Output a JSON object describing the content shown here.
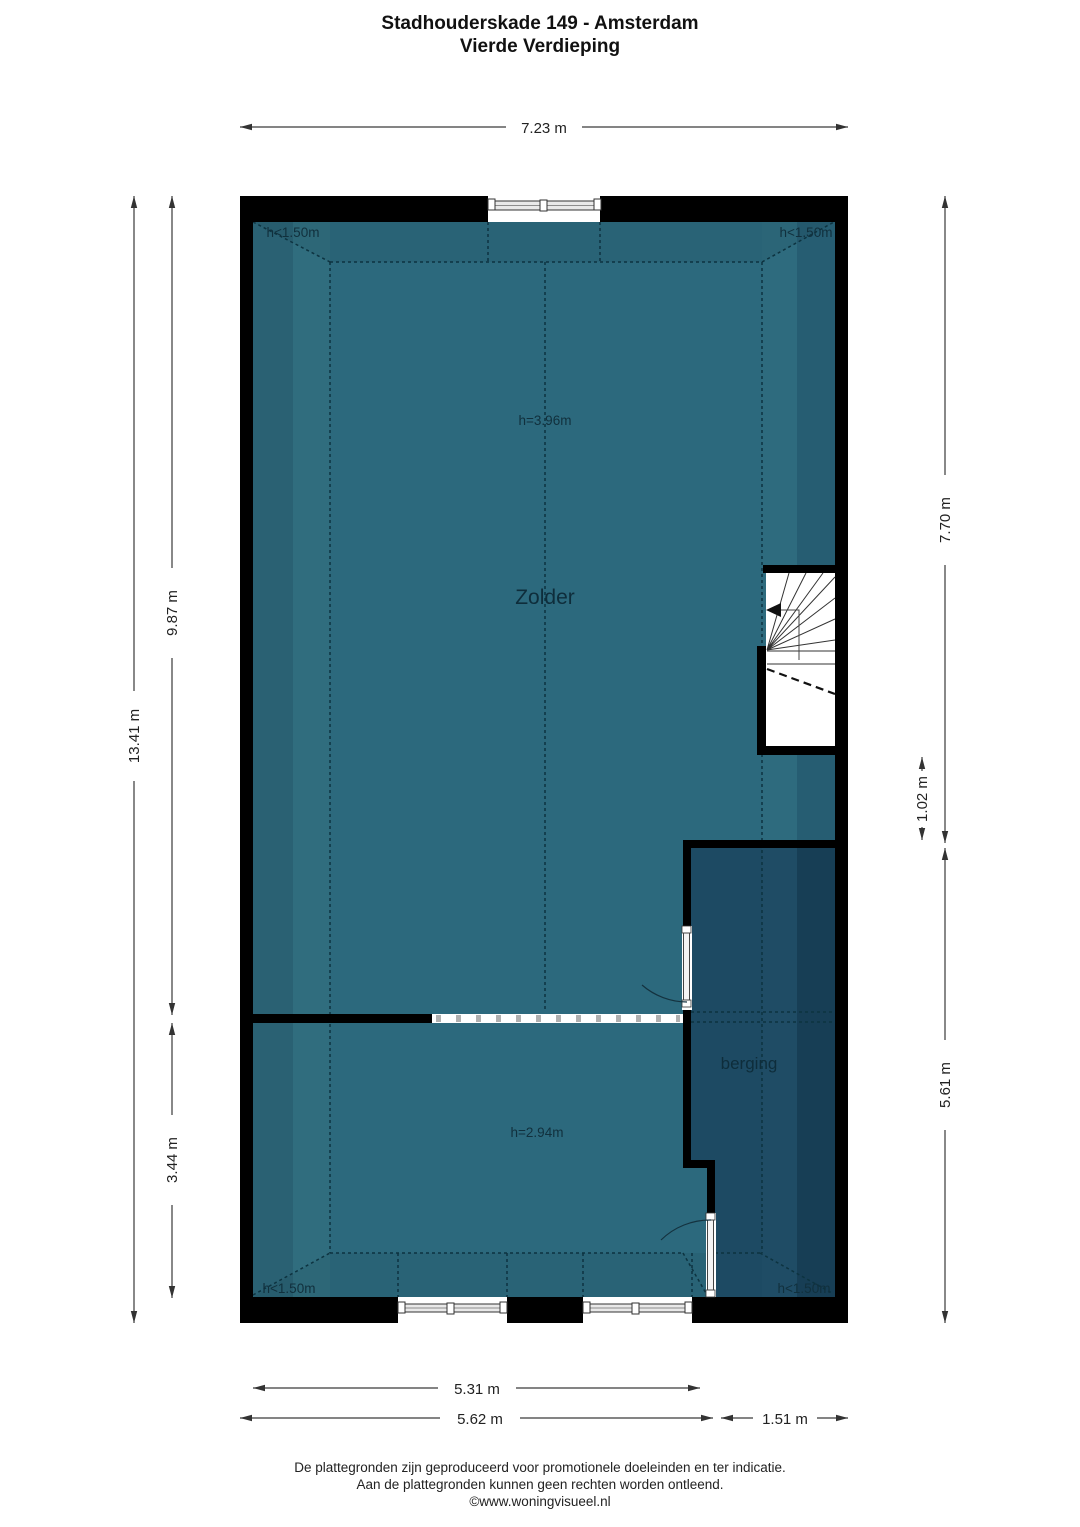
{
  "title": {
    "line1": "Stadhouderskade 149 - Amsterdam",
    "line2": "Vierde Verdieping"
  },
  "plan": {
    "rooms": [
      {
        "name": "zolder",
        "label": "Zolder"
      },
      {
        "name": "berging",
        "label": "berging"
      }
    ],
    "height_labels": {
      "zolder_upper": "h=3.96m",
      "zolder_lower": "h=2.94m",
      "corner_top_left": "h<1.50m",
      "corner_top_right": "h<1.50m",
      "corner_bottom_left": "h<1.50m",
      "corner_bottom_right": "h<1.50m"
    }
  },
  "dimensions": {
    "top_width": "7.23 m",
    "left_total_height": "13.41 m",
    "left_upper_height": "9.87 m",
    "left_lower_height": "3.44 m",
    "right_upper_height": "7.70 m",
    "right_stair_offset": "1.02 m",
    "right_lower_height": "5.61 m",
    "bottom_inner_width": "5.31 m",
    "bottom_left_width": "5.62 m",
    "bottom_right_width": "1.51 m"
  },
  "footer": {
    "line1": "De plattegronden zijn geproduceerd voor promotionele doeleinden en ter indicatie.",
    "line2": "Aan de plattegronden kunnen geen rechten worden ontleend.",
    "line3": "©www.woningvisueel.nl"
  },
  "colors": {
    "wall": "#000000",
    "zolder_floor": "#2c697d",
    "zolder_floor_edge_dark": "#2a6173",
    "zolder_floor_edge_light": "#306d7e",
    "berging_floor": "#1d4a63",
    "berging_floor_edge_dark": "#173e55",
    "berging_floor_edge_mid": "#1f4c65",
    "contour_line": "#0d3340",
    "dimension_line": "#3a3a3a"
  }
}
